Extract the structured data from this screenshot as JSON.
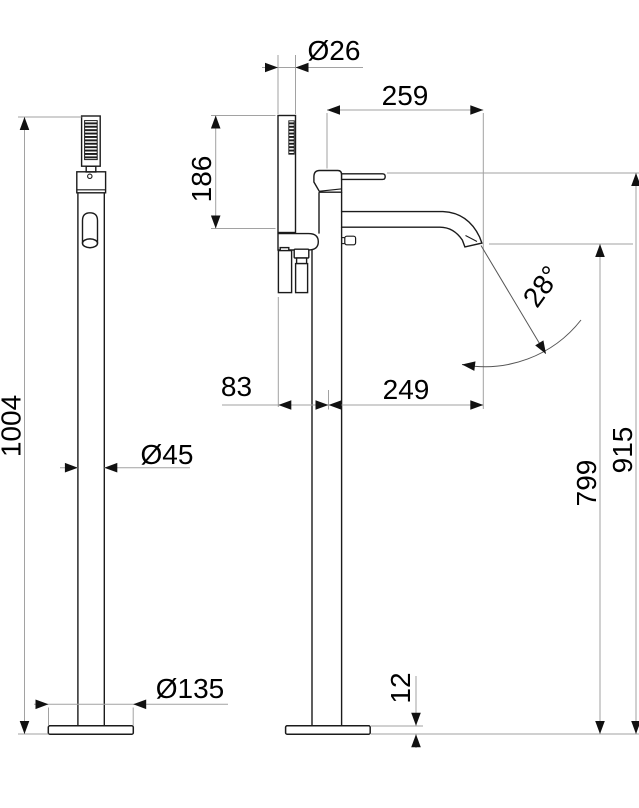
{
  "drawing": {
    "kind": "technical dimension drawing, freestanding bath mixer with hand shower, two views",
    "colors": {
      "background": "#ffffff",
      "object_line": "#1b1b1b",
      "dimension_line": "#a2a2a2",
      "arrow": "#111111",
      "text": "#000000"
    }
  },
  "dimensions": {
    "total_height": "1004",
    "column_diameter": "Ø45",
    "base_diameter": "Ø135",
    "handshower_diameter": "Ø26",
    "handshower_length": "186",
    "spout_projection": "259",
    "handshower_offset": "83",
    "spout_reach": "249",
    "spout_angle": "28°",
    "outlet_height": "799",
    "body_height": "915",
    "base_thickness": "12"
  }
}
